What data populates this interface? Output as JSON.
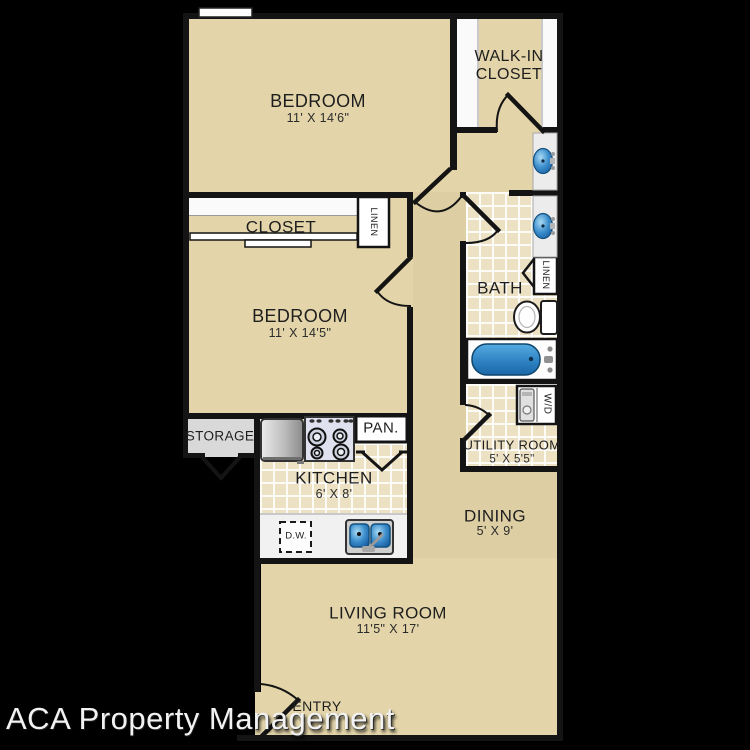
{
  "watermark": "ACA Property Management",
  "rooms": {
    "bedroom_top": {
      "name": "BEDROOM",
      "dims": "11' X 14'6\""
    },
    "walk_in_closet": {
      "name": "WALK-IN CLOSET"
    },
    "closet": {
      "name": "CLOSET"
    },
    "bedroom_mid": {
      "name": "BEDROOM",
      "dims": "11' X 14'5\""
    },
    "bath": {
      "name": "BATH"
    },
    "utility": {
      "name": "UTILITY ROOM",
      "dims": "5' X 5'5\""
    },
    "kitchen": {
      "name": "KITCHEN",
      "dims": "6' X 8'"
    },
    "dining": {
      "name": "DINING",
      "dims": "5' X 9'"
    },
    "living": {
      "name": "LIVING ROOM",
      "dims": "11'5\" X 17'"
    },
    "storage": {
      "name": "STORAGE"
    },
    "entry": {
      "name": "ENTRY"
    }
  },
  "fixtures": {
    "pantry": "PAN.",
    "dishwasher": "D.W.",
    "washer_dryer": "W/D",
    "linen_hall": "LINEN",
    "linen_bath": "LINEN"
  },
  "colors": {
    "background": "#000000",
    "carpet": "#e3d5a9",
    "tile": "#ede1c3",
    "wall": "#141414",
    "fixture_blue": "#2e86c8",
    "counter_gray": "#f1f1f1"
  }
}
